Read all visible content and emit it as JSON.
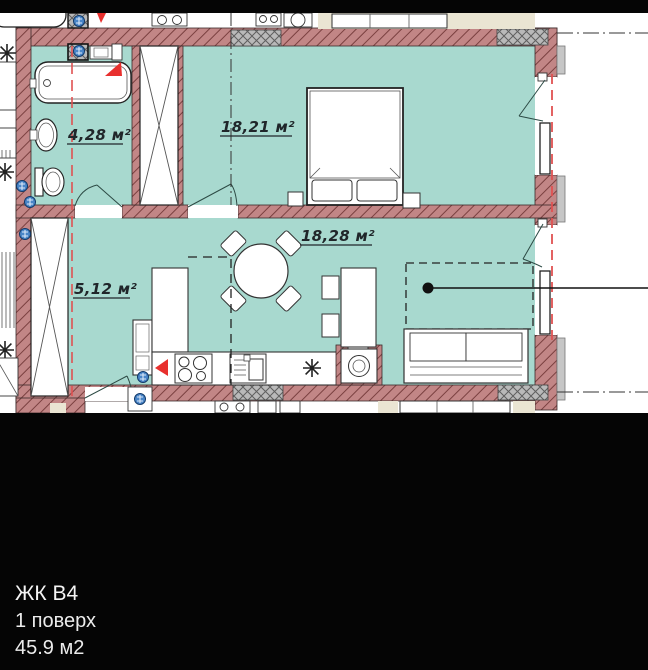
{
  "plan": {
    "rooms": {
      "bathroom": {
        "area_label": "4,28 м²"
      },
      "bedroom": {
        "area_label": "18,21 м²"
      },
      "living": {
        "area_label": "18,28 м²"
      },
      "hallway": {
        "area_label": "5,12 м²"
      }
    },
    "colors": {
      "room_fill": "#a8d9cf",
      "wall_fill": "#c28686",
      "wall_hatch_line": "#7a4040",
      "gray_block": "#b9b9b9",
      "beige_strip": "#eae5d3",
      "accent_red": "#e8302e",
      "axis_red_dashed": "#e05252",
      "valve_blue": "#4a86c8"
    }
  },
  "caption": {
    "complex_name": "ЖК В4",
    "floor": "1 поверх",
    "total_area": "45.9 м2"
  }
}
